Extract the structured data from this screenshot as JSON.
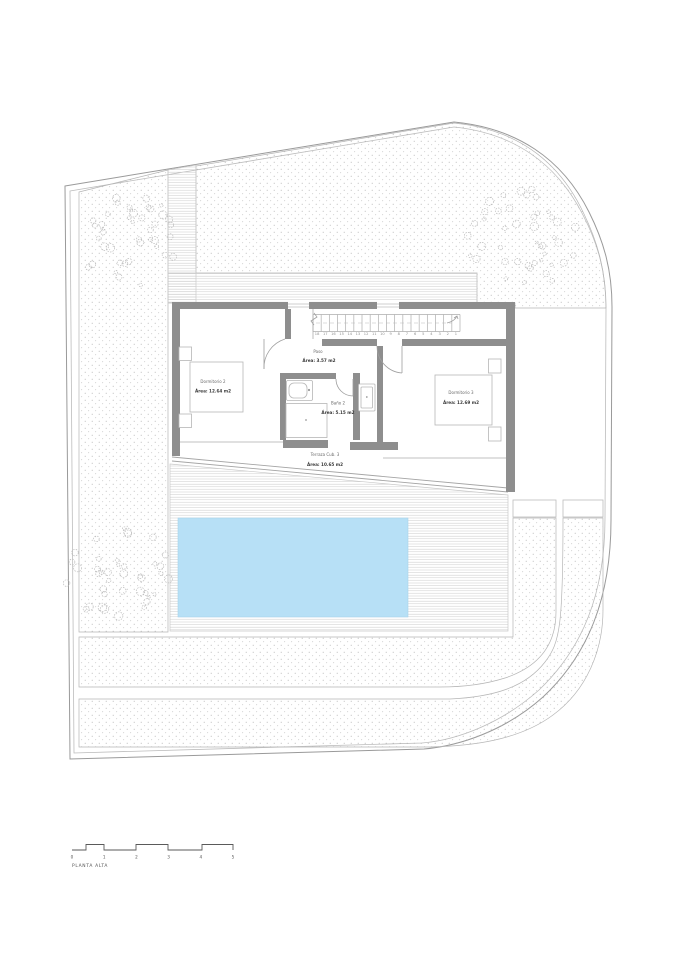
{
  "title": "PLANTA ALTA",
  "colors": {
    "pool": "#b7e0f6",
    "wall": "#8e8e8e",
    "line": "#9a9a9a"
  },
  "rooms": [
    {
      "name": "Dormitorio 2",
      "area": "Área: 12.64 m2"
    },
    {
      "name": "Paso",
      "area": "Área: 3.57 m2"
    },
    {
      "name": "Baño 2",
      "area": "Área: 5.15 m2"
    },
    {
      "name": "Dormitorio 3",
      "area": "Área: 12.69 m2"
    },
    {
      "name": "Terraza Cub. 3",
      "area": "Área: 10.65 m2"
    }
  ],
  "stairs": {
    "numbers": [
      "18",
      "17",
      "16",
      "15",
      "14",
      "13",
      "12",
      "11",
      "10",
      "9",
      "8",
      "7",
      "6",
      "5",
      "4",
      "3",
      "2",
      "1"
    ]
  },
  "scale_bar": {
    "labels": [
      "0",
      "1",
      "2",
      "3",
      "4",
      "5"
    ]
  }
}
